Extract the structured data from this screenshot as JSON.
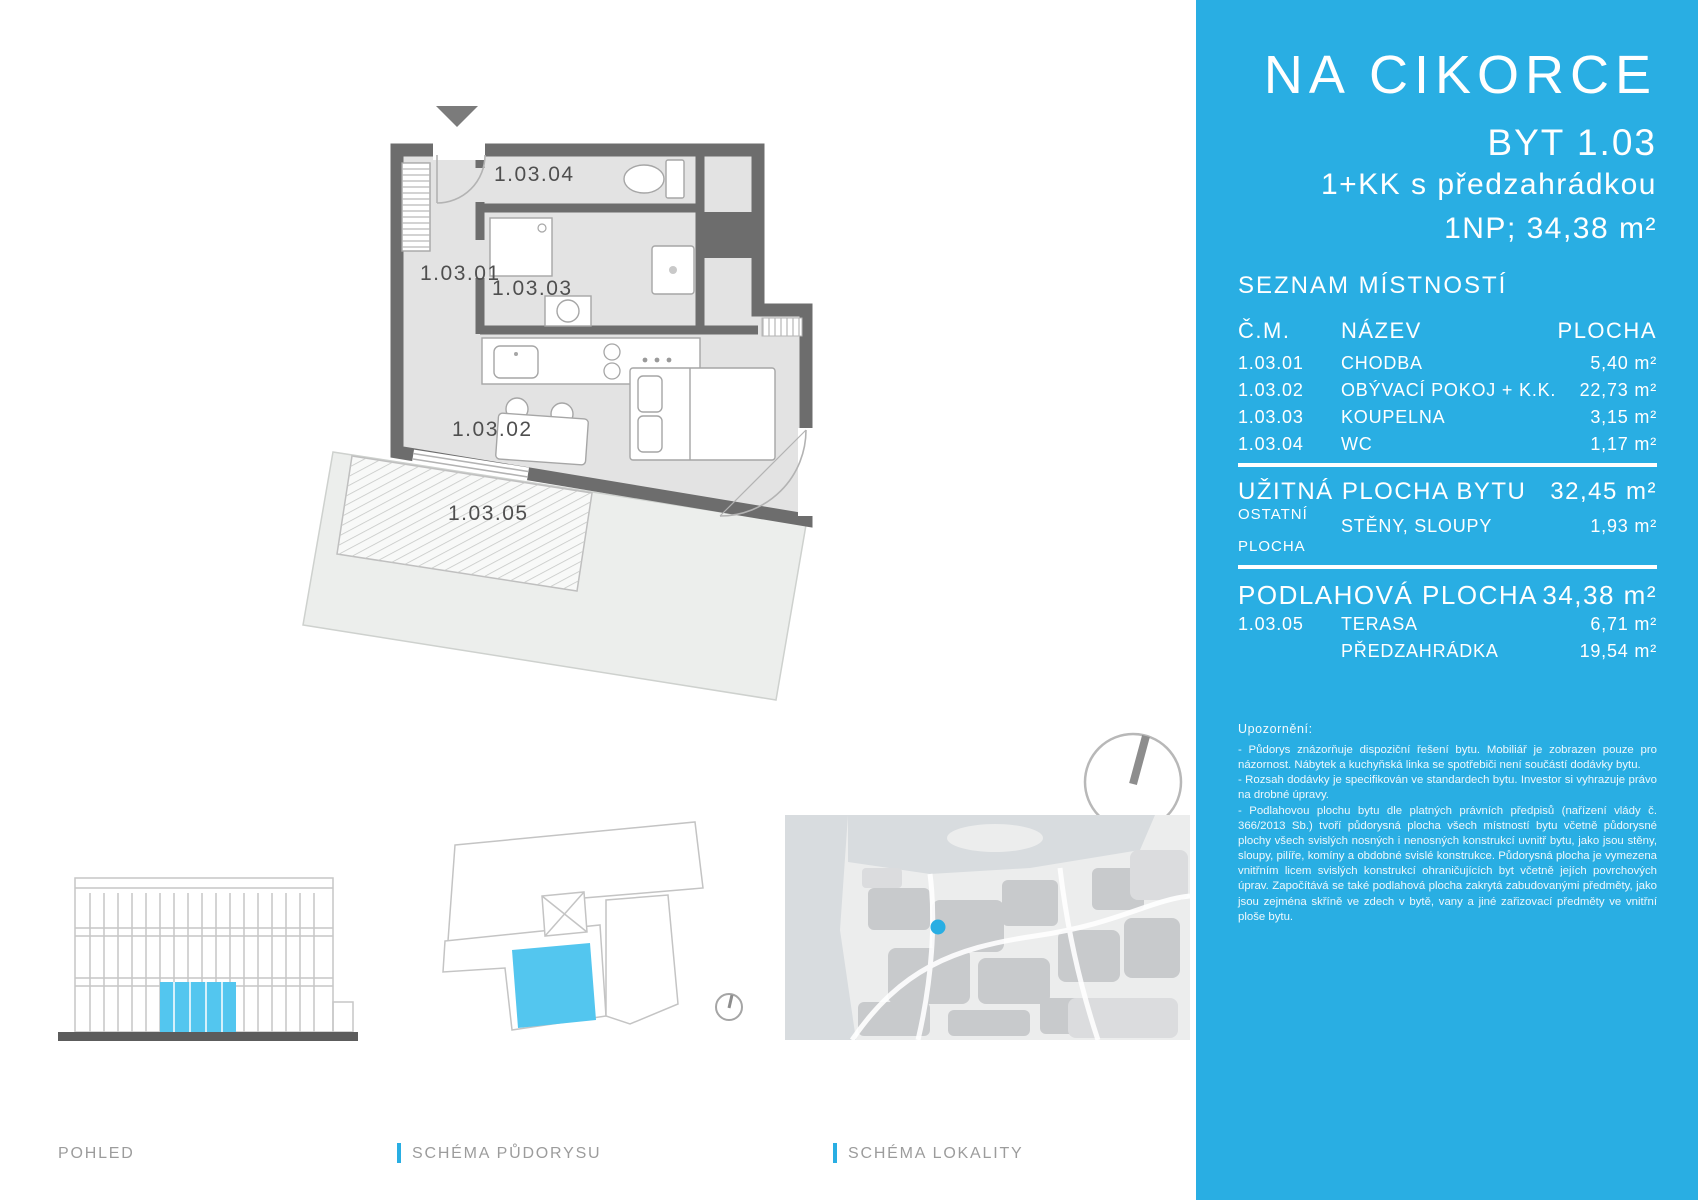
{
  "panel": {
    "accent_color": "#29aee3",
    "title": "NA CIKORCE",
    "unit_code": "BYT 1.03",
    "unit_type": "1+KK s předzahrádkou",
    "unit_floor_area": "1NP; 34,38 m²",
    "room_list": {
      "heading": "SEZNAM MÍSTNOSTÍ",
      "columns": {
        "num": "Č.M.",
        "name": "NÁZEV",
        "area": "PLOCHA"
      },
      "rows": [
        {
          "num": "1.03.01",
          "name": "CHODBA",
          "area": "5,40 m²"
        },
        {
          "num": "1.03.02",
          "name": "OBÝVACÍ POKOJ + K.K.",
          "area": "22,73 m²"
        },
        {
          "num": "1.03.03",
          "name": "KOUPELNA",
          "area": "3,15 m²"
        },
        {
          "num": "1.03.04",
          "name": "WC",
          "area": "1,17 m²"
        }
      ]
    },
    "usable_area": {
      "label": "UŽITNÁ PLOCHA BYTU",
      "value": "32,45 m²"
    },
    "other_area": {
      "label_line1": "OSTATNÍ",
      "label_line2": "PLOCHA",
      "name": "STĚNY, SLOUPY",
      "value": "1,93 m²"
    },
    "floor_area_total": {
      "label": "PODLAHOVÁ PLOCHA",
      "value": "34,38 m²"
    },
    "exterior_rows": [
      {
        "num": "1.03.05",
        "name": "TERASA",
        "area": "6,71 m²"
      },
      {
        "num": "",
        "name": "PŘEDZAHRÁDKA",
        "area": "19,54 m²"
      }
    ],
    "notice_heading": "Upozornění:",
    "notice_paragraphs": [
      "- Půdorys znázorňuje dispoziční řešení bytu. Mobiliář je zobrazen pouze pro názornost. Nábytek a kuchyňská linka se spotřebiči není součástí dodávky bytu.",
      "- Rozsah dodávky je specifikován ve standardech bytu. Investor si vyhrazuje právo na drobné úpravy.",
      "- Podlahovou plochu bytu dle platných právních předpisů (nařízení vlády č. 366/2013 Sb.) tvoří půdorysná plocha všech místností bytu včetně půdorysné plochy všech svislých nosných i nenosných konstrukcí uvnitř bytu, jako jsou stěny, sloupy, pilíře, komíny a obdobné svislé konstrukce. Půdorysná plocha je vymezena vnitřním licem svislých konstrukcí ohraničujících byt včetně jejích povrchových úprav. Započítává se také podlahová plocha zakrytá zabudovanými předměty, jako jsou zejména skříně ve zdech v bytě, vany a jiné zařizovací předměty ve vnitřní ploše bytu."
    ]
  },
  "floorplan": {
    "labels": {
      "hall": "1.03.01",
      "living": "1.03.02",
      "bath": "1.03.03",
      "wc": "1.03.04",
      "terrace": "1.03.05"
    }
  },
  "footer": {
    "view_label": "POHLED",
    "plan_schema_label": "SCHÉMA PŮDORYSU",
    "locality_schema_label": "SCHÉMA LOKALITY"
  }
}
